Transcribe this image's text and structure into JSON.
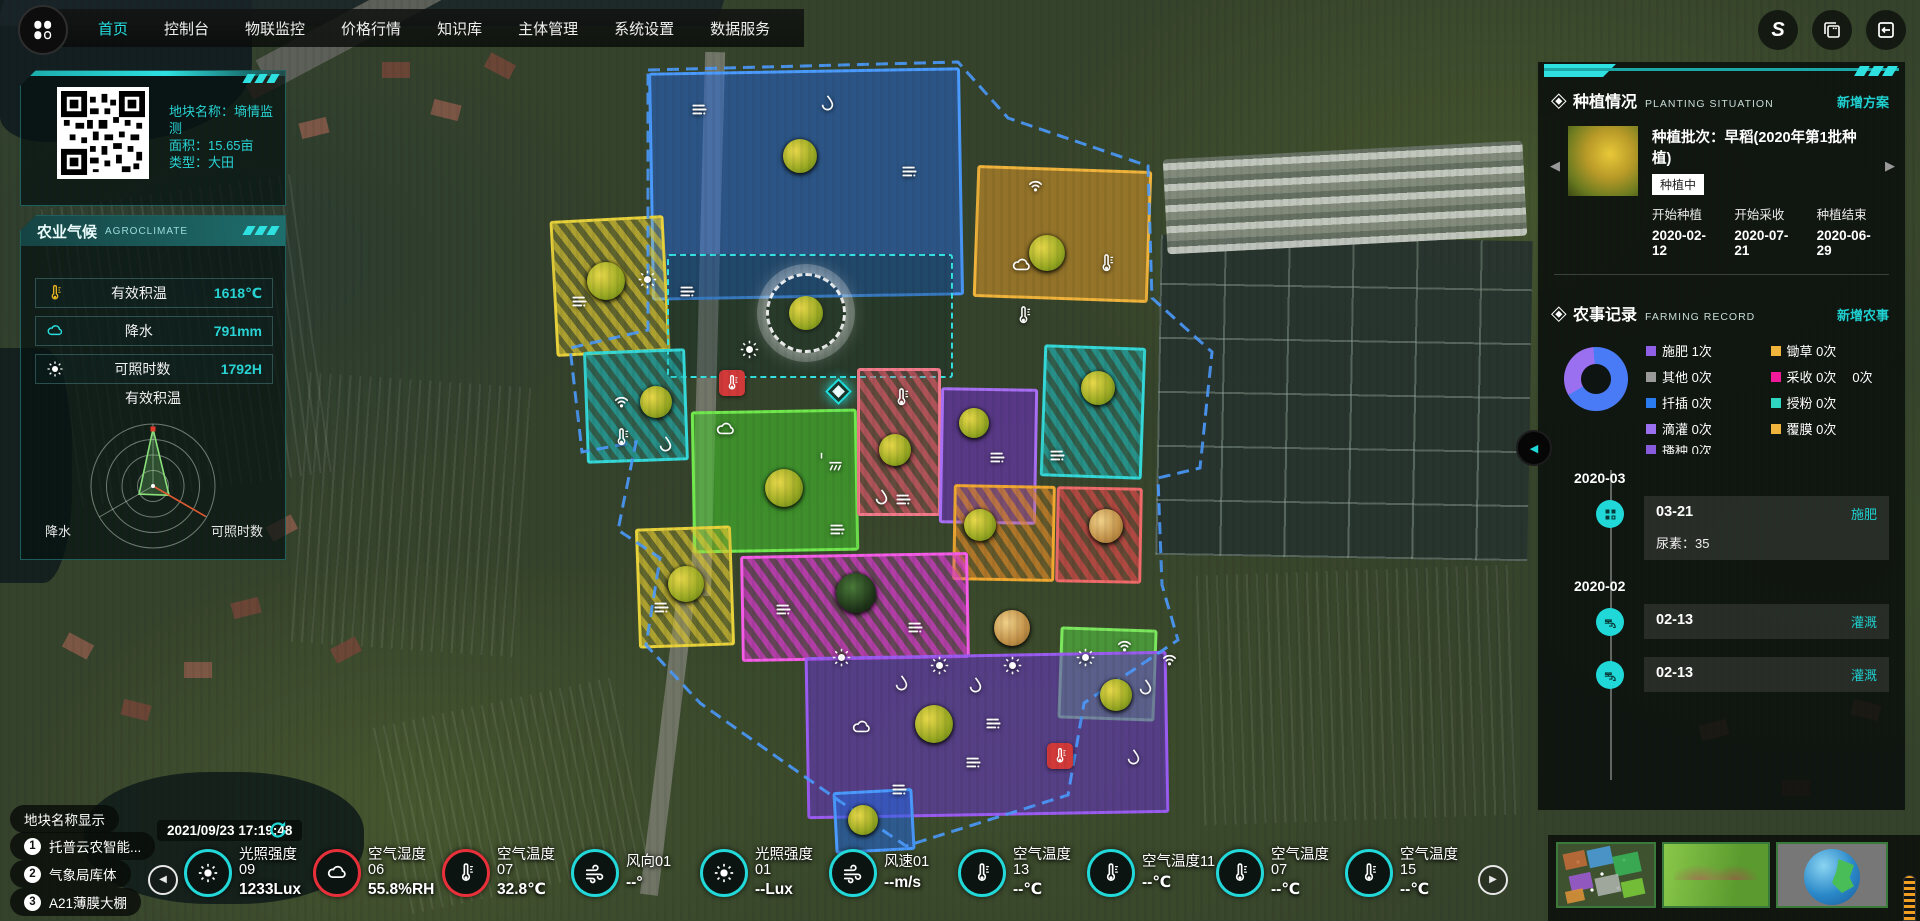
{
  "nav": {
    "items": [
      {
        "label": "首页",
        "active": true
      },
      {
        "label": "控制台",
        "active": false
      },
      {
        "label": "物联监控",
        "active": false
      },
      {
        "label": "价格行情",
        "active": false
      },
      {
        "label": "知识库",
        "active": false
      },
      {
        "label": "主体管理",
        "active": false
      },
      {
        "label": "系统设置",
        "active": false
      },
      {
        "label": "数据服务",
        "active": false
      }
    ]
  },
  "accent_color": "#25e0e0",
  "plot_info": {
    "name": "地块名称：墒情监测",
    "area": "面积：15.65亩",
    "type": "类型：大田"
  },
  "agroclimate": {
    "title_cn": "农业气候",
    "title_en": "AGROCLIMATE",
    "metrics": [
      {
        "icon": "therm",
        "color": "#e8b422",
        "label": "有效积温",
        "value": "1618℃"
      },
      {
        "icon": "cloud",
        "color": "#29dede",
        "label": "降水",
        "value": "791mm"
      },
      {
        "icon": "sun",
        "color": "#ffffff",
        "label": "可照时数",
        "value": "1792H"
      }
    ],
    "radar": {
      "axes": [
        "有效积温",
        "可照时数",
        "降水"
      ],
      "values": [
        0.92,
        0.3,
        0.26
      ]
    }
  },
  "planting": {
    "title_cn": "种植情况",
    "title_en": "PLANTING SITUATION",
    "action": "新增方案",
    "batch": "种植批次：早稻(2020年第1批种植)",
    "status": "种植中",
    "cols": [
      {
        "label": "开始种植",
        "date": "2020-02-12"
      },
      {
        "label": "开始采收",
        "date": "2020-07-21"
      },
      {
        "label": "种植结束",
        "date": "2020-06-29"
      }
    ]
  },
  "farming": {
    "title_cn": "农事记录",
    "title_en": "FARMING RECORD",
    "action": "新增农事",
    "donut": {
      "from_deg": 240,
      "segments": [
        {
          "name": "施肥",
          "color": "#9a6ff0",
          "deg": 115
        },
        {
          "name": "其余",
          "color": "#4a7bf7",
          "deg": 245
        }
      ]
    },
    "legend": [
      {
        "label": "施肥",
        "count": "1次",
        "color": "#8f5fe8"
      },
      {
        "label": "锄草",
        "count": "0次",
        "color": "#f0b43c"
      },
      {
        "label": "其他",
        "count": "0次",
        "color": "#9a9a9a"
      },
      {
        "label": "采收",
        "count": "0次",
        "color": "#f0199a",
        "extra": "0次"
      },
      {
        "label": "扦插",
        "count": "0次",
        "color": "#2b7bf0"
      },
      {
        "label": "授粉",
        "count": "0次",
        "color": "#2fd5c0"
      },
      {
        "label": "滴灌",
        "count": "0次",
        "color": "#9a6ff0"
      },
      {
        "label": "覆膜",
        "count": "0次",
        "color": "#f0b43c"
      }
    ],
    "clipped": {
      "label": "播种",
      "count": "0次",
      "color": "#8f5fe8"
    },
    "timeline": [
      {
        "kind": "month",
        "label": "2020-03"
      },
      {
        "kind": "event",
        "icon": "grid",
        "date": "03-21",
        "tag": "施肥",
        "detail": "尿素：35"
      },
      {
        "kind": "month",
        "label": "2020-02"
      },
      {
        "kind": "event",
        "icon": "faucet",
        "date": "02-13",
        "tag": "灌溉",
        "detail": ""
      },
      {
        "kind": "event",
        "icon": "faucet",
        "date": "02-13",
        "tag": "灌溉",
        "detail": ""
      }
    ]
  },
  "footer_left": {
    "toggle": "地块名称显示",
    "items": [
      {
        "num": "1",
        "label": "托普云农智能..."
      },
      {
        "num": "2",
        "label": "气象局库体"
      },
      {
        "num": "3",
        "label": "A21薄膜大棚"
      }
    ],
    "timestamp": "2021/09/23 17:19:48"
  },
  "sensors": [
    {
      "name": "光照强度09",
      "value": "1233Lux",
      "icon": "sun",
      "ring": "cyan"
    },
    {
      "name": "空气湿度06",
      "value": "55.8%RH",
      "icon": "cloud",
      "ring": "red"
    },
    {
      "name": "空气温度07",
      "value": "32.8℃",
      "icon": "therm",
      "ring": "red"
    },
    {
      "name": "风向01",
      "value": "--°",
      "icon": "wind",
      "ring": "cyan"
    },
    {
      "name": "光照强度01",
      "value": "--Lux",
      "icon": "sun",
      "ring": "cyan"
    },
    {
      "name": "风速01",
      "value": "--m/s",
      "icon": "wind",
      "ring": "cyan"
    },
    {
      "name": "空气温度13",
      "value": "--℃",
      "icon": "therm",
      "ring": "cyan"
    },
    {
      "name": "空气温度11",
      "value": "--℃",
      "icon": "therm",
      "ring": "cyan"
    },
    {
      "name": "空气温度07",
      "value": "--℃",
      "icon": "therm",
      "ring": "cyan"
    },
    {
      "name": "空气温度15",
      "value": "--℃",
      "icon": "therm",
      "ring": "cyan"
    }
  ],
  "map": {
    "parcels": [
      {
        "x": 650,
        "y": 70,
        "w": 312,
        "h": 228,
        "rot": -1,
        "fill": "#2268e0",
        "alpha": 0.5,
        "border": "#4b9bff"
      },
      {
        "x": 975,
        "y": 168,
        "w": 175,
        "h": 132,
        "rot": 2,
        "fill": "#e09a28",
        "alpha": 0.55,
        "border": "#f0b43c"
      },
      {
        "x": 553,
        "y": 218,
        "w": 114,
        "h": 136,
        "rot": -3,
        "fill": "#ddc731",
        "alpha": 0.5,
        "border": "#e8d23c",
        "stripe": true
      },
      {
        "x": 667,
        "y": 254,
        "w": 286,
        "h": 124,
        "rot": 0,
        "fill": "#0a2828",
        "alpha": 0.3,
        "border": "#35e0e0",
        "dashed": true
      },
      {
        "x": 585,
        "y": 350,
        "w": 102,
        "h": 112,
        "rot": -2,
        "fill": "#1fb8b8",
        "alpha": 0.45,
        "border": "#35d8d8",
        "stripe": true
      },
      {
        "x": 692,
        "y": 410,
        "w": 166,
        "h": 142,
        "rot": -1,
        "fill": "#46cc2e",
        "alpha": 0.55,
        "border": "#71e84e"
      },
      {
        "x": 857,
        "y": 368,
        "w": 84,
        "h": 148,
        "rot": 0,
        "fill": "#e05a6a",
        "alpha": 0.5,
        "border": "#f07a8a",
        "stripe": true
      },
      {
        "x": 940,
        "y": 388,
        "w": 97,
        "h": 136,
        "rot": 1,
        "fill": "#7a2ee0",
        "alpha": 0.5,
        "border": "#a86ff5"
      },
      {
        "x": 1042,
        "y": 346,
        "w": 102,
        "h": 132,
        "rot": 2,
        "fill": "#1fb8b8",
        "alpha": 0.45,
        "border": "#35d8d8",
        "stripe": true
      },
      {
        "x": 953,
        "y": 485,
        "w": 102,
        "h": 96,
        "rot": 1,
        "fill": "#e08a28",
        "alpha": 0.5,
        "border": "#f0a830",
        "stripe": true
      },
      {
        "x": 1056,
        "y": 487,
        "w": 86,
        "h": 96,
        "rot": 1,
        "fill": "#e04a4a",
        "alpha": 0.5,
        "border": "#f06a6a",
        "stripe": true
      },
      {
        "x": 637,
        "y": 527,
        "w": 96,
        "h": 120,
        "rot": -2,
        "fill": "#ddc731",
        "alpha": 0.5,
        "border": "#e8d23c",
        "stripe": true
      },
      {
        "x": 741,
        "y": 554,
        "w": 228,
        "h": 106,
        "rot": -1,
        "fill": "#e23ad8",
        "alpha": 0.5,
        "border": "#f55ce8",
        "stripe": true
      },
      {
        "x": 1059,
        "y": 628,
        "w": 97,
        "h": 92,
        "rot": 2,
        "fill": "#58d246",
        "alpha": 0.55,
        "border": "#7ce85e"
      },
      {
        "x": 806,
        "y": 654,
        "w": 362,
        "h": 162,
        "rot": -1,
        "fill": "#6a34d0",
        "alpha": 0.55,
        "border": "#9a5cf0"
      },
      {
        "x": 834,
        "y": 790,
        "w": 80,
        "h": 62,
        "rot": -3,
        "fill": "#2268e0",
        "alpha": 0.55,
        "border": "#4b9bff"
      }
    ],
    "markers": [
      {
        "t": "lines",
        "x": 700,
        "y": 110
      },
      {
        "t": "drop",
        "x": 828,
        "y": 104
      },
      {
        "t": "lines",
        "x": 910,
        "y": 172
      },
      {
        "t": "crop",
        "v": "rice",
        "x": 800,
        "y": 156,
        "s": 34
      },
      {
        "t": "wifi",
        "x": 1036,
        "y": 186
      },
      {
        "t": "crop",
        "v": "rice",
        "x": 1047,
        "y": 253,
        "s": 36
      },
      {
        "t": "cloud",
        "x": 1022,
        "y": 266
      },
      {
        "t": "therm",
        "x": 1107,
        "y": 264
      },
      {
        "t": "therm",
        "x": 1024,
        "y": 316
      },
      {
        "t": "crop",
        "v": "rice",
        "x": 606,
        "y": 281,
        "s": 38
      },
      {
        "t": "sun",
        "x": 648,
        "y": 280
      },
      {
        "t": "lines",
        "x": 580,
        "y": 302
      },
      {
        "t": "station",
        "x": 803,
        "y": 310
      },
      {
        "t": "thermbadge",
        "x": 732,
        "y": 383
      },
      {
        "t": "lines",
        "x": 688,
        "y": 292
      },
      {
        "t": "diamond",
        "x": 837,
        "y": 390
      },
      {
        "t": "sun",
        "x": 750,
        "y": 350
      },
      {
        "t": "wifi",
        "x": 622,
        "y": 402
      },
      {
        "t": "crop",
        "v": "rice",
        "x": 656,
        "y": 402,
        "s": 32
      },
      {
        "t": "therm",
        "x": 622,
        "y": 438
      },
      {
        "t": "drop",
        "x": 666,
        "y": 445
      },
      {
        "t": "cloud",
        "x": 726,
        "y": 430
      },
      {
        "t": "sprout",
        "x": 822,
        "y": 452
      },
      {
        "t": "crop",
        "v": "rice",
        "x": 784,
        "y": 488,
        "s": 38
      },
      {
        "t": "shower",
        "x": 836,
        "y": 468
      },
      {
        "t": "lines",
        "x": 838,
        "y": 530
      },
      {
        "t": "crop",
        "v": "rice",
        "x": 895,
        "y": 450,
        "s": 32
      },
      {
        "t": "drop",
        "x": 882,
        "y": 498
      },
      {
        "t": "lines",
        "x": 904,
        "y": 500
      },
      {
        "t": "therm",
        "x": 902,
        "y": 398
      },
      {
        "t": "crop",
        "v": "rice",
        "x": 974,
        "y": 423,
        "s": 30
      },
      {
        "t": "lines",
        "x": 998,
        "y": 458
      },
      {
        "t": "crop",
        "v": "rice",
        "x": 1098,
        "y": 388,
        "s": 34
      },
      {
        "t": "lines",
        "x": 1058,
        "y": 456
      },
      {
        "t": "crop",
        "v": "rice",
        "x": 980,
        "y": 525,
        "s": 32
      },
      {
        "t": "crop",
        "v": "corn",
        "x": 1106,
        "y": 526,
        "s": 34
      },
      {
        "t": "crop",
        "v": "rice",
        "x": 686,
        "y": 584,
        "s": 36
      },
      {
        "t": "lines",
        "x": 662,
        "y": 608
      },
      {
        "t": "crop",
        "v": "chive",
        "x": 856,
        "y": 593,
        "s": 40
      },
      {
        "t": "lines",
        "x": 784,
        "y": 610
      },
      {
        "t": "lines",
        "x": 916,
        "y": 628
      },
      {
        "t": "crop",
        "v": "corn",
        "x": 1012,
        "y": 628,
        "s": 36
      },
      {
        "t": "sun",
        "x": 842,
        "y": 658
      },
      {
        "t": "sun",
        "x": 940,
        "y": 666
      },
      {
        "t": "sun",
        "x": 1013,
        "y": 666
      },
      {
        "t": "sun",
        "x": 1086,
        "y": 658
      },
      {
        "t": "drop",
        "x": 902,
        "y": 684
      },
      {
        "t": "drop",
        "x": 976,
        "y": 686
      },
      {
        "t": "drop",
        "x": 1146,
        "y": 688
      },
      {
        "t": "wifi",
        "x": 1170,
        "y": 660
      },
      {
        "t": "cloud",
        "x": 862,
        "y": 728
      },
      {
        "t": "crop",
        "v": "rice",
        "x": 934,
        "y": 724,
        "s": 38
      },
      {
        "t": "lines",
        "x": 994,
        "y": 724
      },
      {
        "t": "lines",
        "x": 974,
        "y": 763
      },
      {
        "t": "thermbadge",
        "x": 1060,
        "y": 756
      },
      {
        "t": "drop",
        "x": 1134,
        "y": 758
      },
      {
        "t": "leaf",
        "x": 1158,
        "y": 734
      },
      {
        "t": "lines",
        "x": 900,
        "y": 790
      },
      {
        "t": "wifi",
        "x": 1125,
        "y": 646
      },
      {
        "t": "crop",
        "v": "rice",
        "x": 1116,
        "y": 695,
        "s": 32
      },
      {
        "t": "crop",
        "v": "rice",
        "x": 863,
        "y": 820,
        "s": 30
      }
    ]
  }
}
